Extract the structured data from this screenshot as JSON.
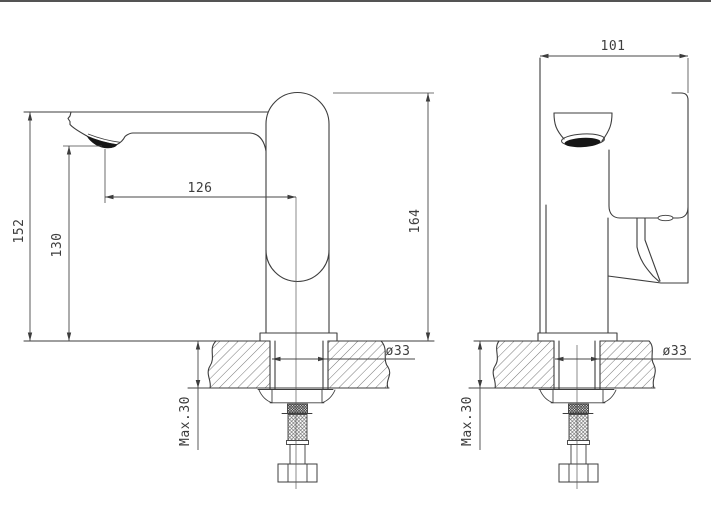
{
  "drawing": {
    "kind": "faucet installation technical drawing",
    "left_view": {
      "overall_height": "152",
      "spout_height": "130",
      "spout_reach": "126",
      "body_height": "164",
      "hole_diameter": "ø33",
      "max_deck_thickness": "Max.30"
    },
    "right_view": {
      "body_depth": "101",
      "hole_diameter": "ø33",
      "max_deck_thickness": "Max.30"
    }
  }
}
